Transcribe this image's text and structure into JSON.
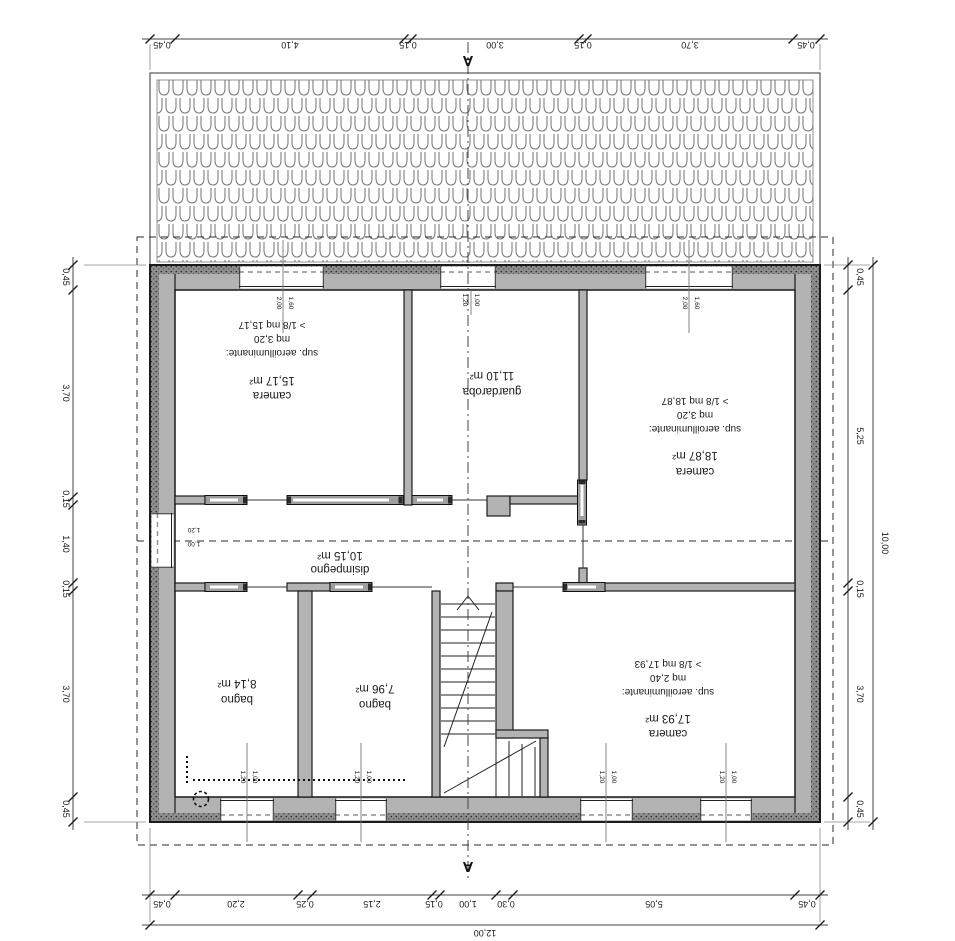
{
  "section": {
    "label": "A"
  },
  "rooms": [
    {
      "id": "camera-nw",
      "name": "camera",
      "area": "15,17 m²",
      "vent_lines": [
        "sup. aeroilluminante:",
        "mq 3,20",
        "> 1/8 mq 15,17"
      ]
    },
    {
      "id": "guardaroba",
      "name": "guardaroba",
      "area": "11,10 m²"
    },
    {
      "id": "camera-e",
      "name": "camera",
      "area": "18,87 m²",
      "vent_lines": [
        "sup. aeroilluminante:",
        "mq 3,20",
        "> 1/8 mq 18,87"
      ]
    },
    {
      "id": "disimpegno",
      "name": "disimpegno",
      "area": "10,15 m²"
    },
    {
      "id": "bagno-w",
      "name": "bagno",
      "area": "8,14 m²"
    },
    {
      "id": "bagno-c",
      "name": "bagno",
      "area": "7,96 m²"
    },
    {
      "id": "camera-se",
      "name": "camera",
      "area": "17,93 m²",
      "vent_lines": [
        "sup. aeroilluminante:",
        "mq 2,40",
        "> 1/8 mq 17,93"
      ]
    }
  ],
  "dimensions": {
    "top": [
      "0,45",
      "4,10",
      "0,15",
      "3,00",
      "0,15",
      "3,70",
      "0,45"
    ],
    "bottom": [
      "0,45",
      "2,20",
      "0,25",
      "2,15",
      "0,15",
      "1,00",
      "0,30",
      "5,05",
      "0,45"
    ],
    "bottom_total": "12,00",
    "left": [
      "0,45",
      "3,70",
      "0,15",
      "1,40",
      "0,15",
      "3,70",
      "0,45"
    ],
    "right": [
      "0,45",
      "5,25",
      "0,15",
      "3,70",
      "0,45"
    ],
    "right_total": "10,00"
  },
  "window_labels": {
    "large": {
      "w": "1,60",
      "h": "2,00"
    },
    "small": {
      "w": "1,00",
      "h": "1,20"
    }
  }
}
